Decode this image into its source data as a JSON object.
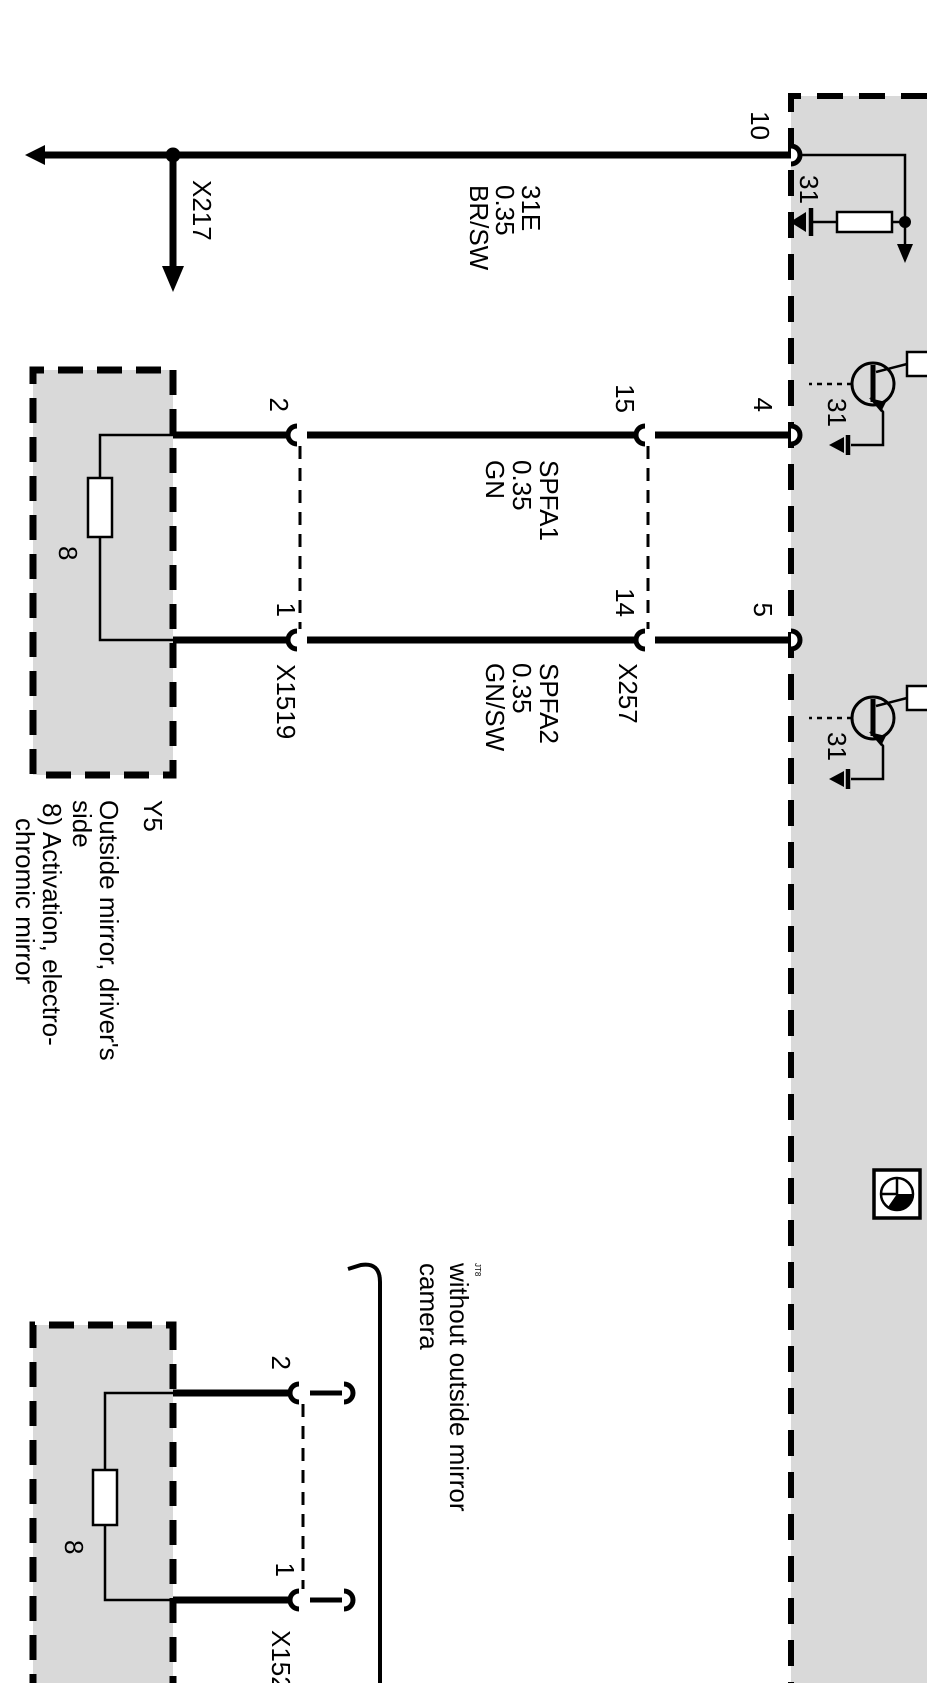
{
  "module": {
    "pin10": "10",
    "pin4": "4",
    "pin5": "5",
    "ground1": "31",
    "ground2": "31",
    "ground3": "31"
  },
  "wire_31e": {
    "circuit": "31E",
    "gauge": "0.35",
    "color": "BR/SW"
  },
  "wire_spfa1": {
    "circuit": "SPFA1",
    "gauge": "0.35",
    "color": "GN"
  },
  "wire_spfa2": {
    "circuit": "SPFA2",
    "gauge": "0.35",
    "color": "GN/SW"
  },
  "x217": {
    "label": "X217"
  },
  "x257": {
    "label": "X257",
    "pin_left": "15",
    "pin_right": "14"
  },
  "x1519": {
    "label": "X1519",
    "pin_left": "2",
    "pin_right": "1"
  },
  "x152": {
    "label": "X152",
    "pin_left": "2",
    "pin_right": "1"
  },
  "y5": {
    "id": "Y5",
    "name1": "Outside mirror, driver's",
    "name2": "side",
    "note1": "8) Activation, electro-",
    "note2": "chromic mirror",
    "element": "8"
  },
  "mirror2": {
    "element": "8"
  },
  "variant": {
    "mark": "JT8",
    "line1": "without outside mirror",
    "line2": "camera"
  },
  "colors": {
    "fill": "#d9d9d9",
    "ink": "#000000"
  }
}
